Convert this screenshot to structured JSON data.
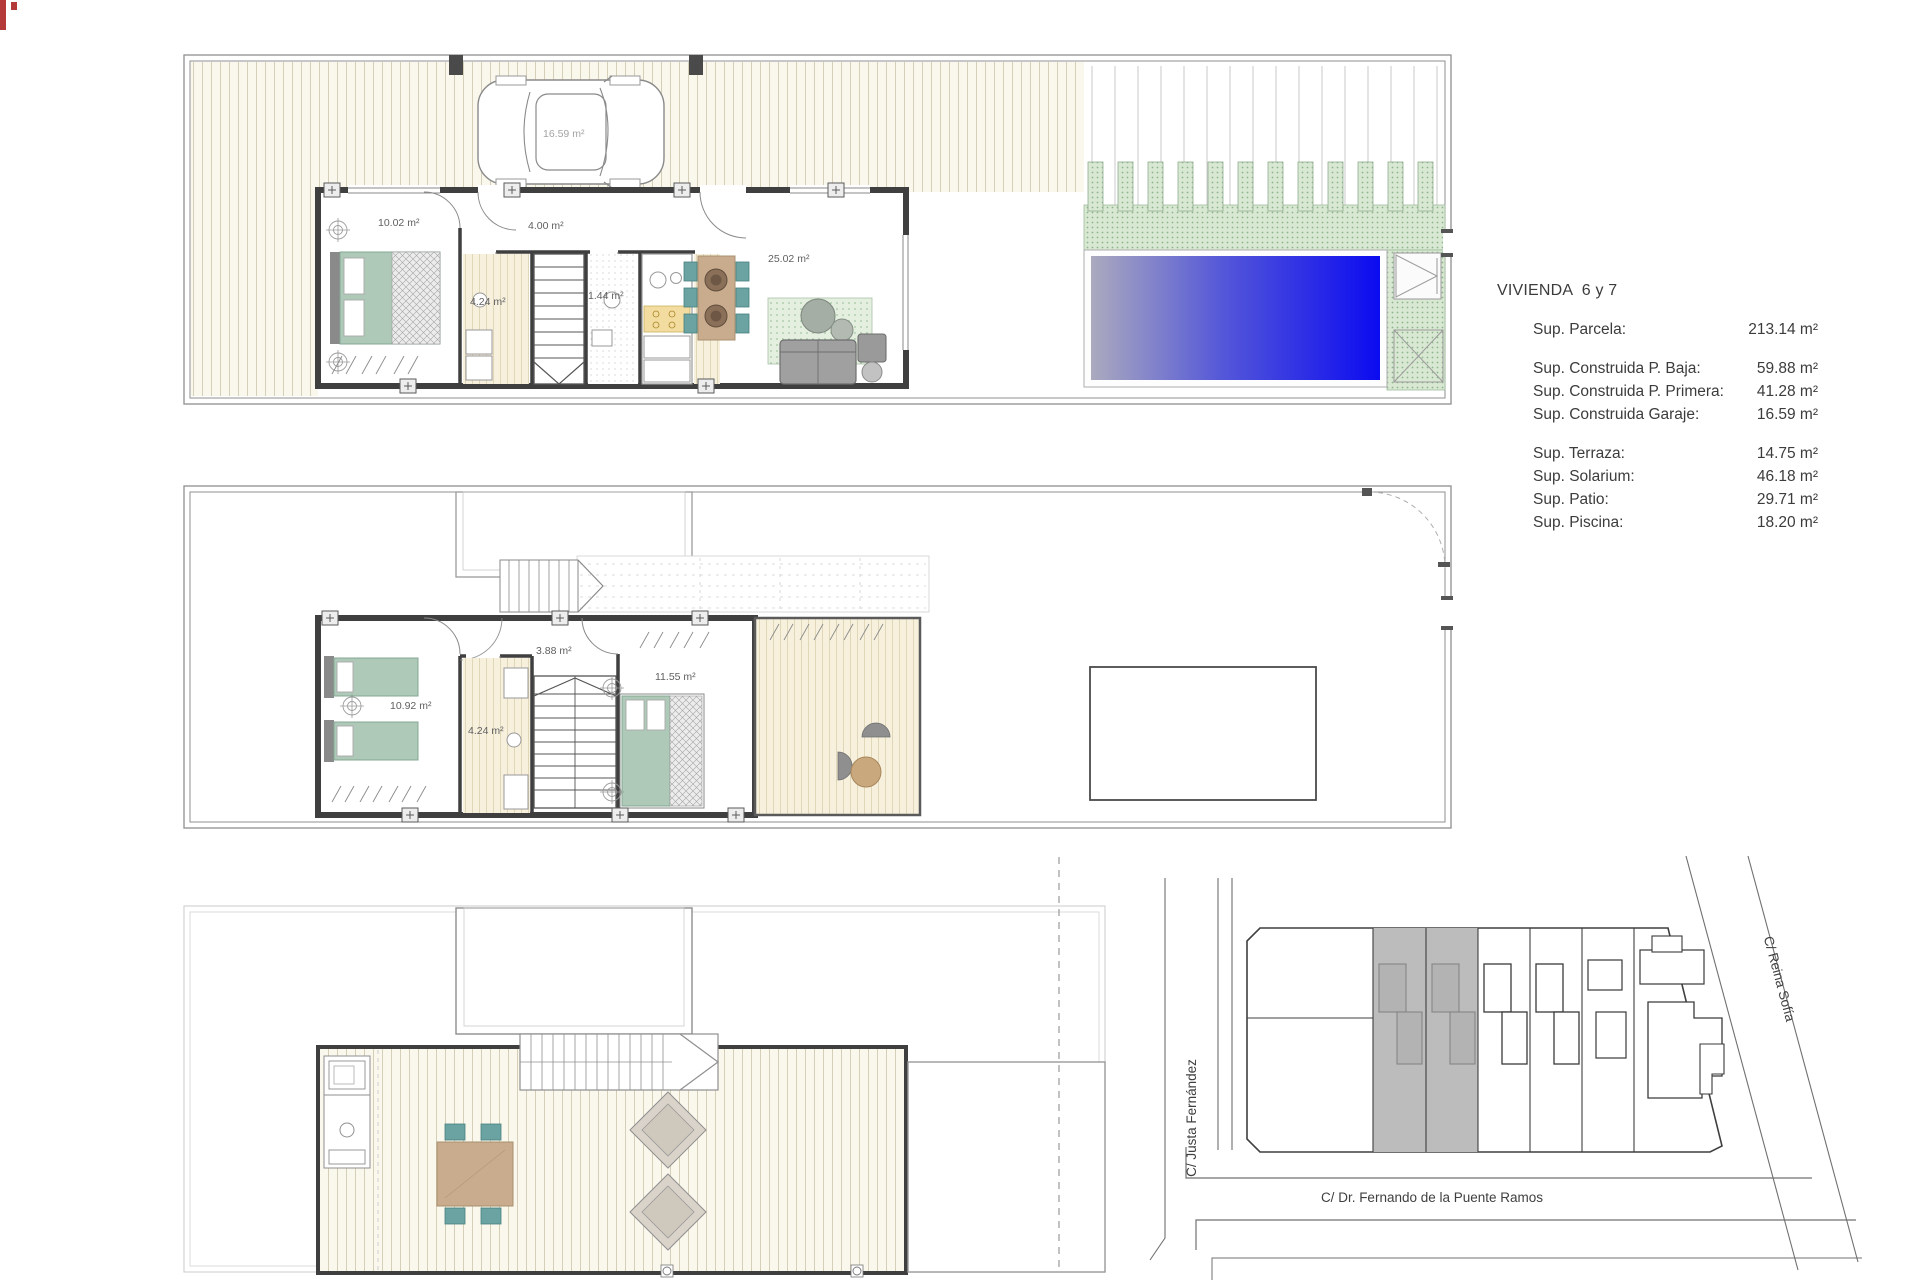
{
  "document": {
    "heading": "VIVIENDA  6 y 7",
    "summary": [
      {
        "label": "Sup. Parcela:",
        "value": "213.14 m²"
      },
      {
        "label": "Sup. Construida P. Baja:",
        "value": "59.88 m²"
      },
      {
        "label": "Sup. Construida P. Primera:",
        "value": "41.28 m²"
      },
      {
        "label": "Sup. Construida Garaje:",
        "value": "16.59 m²"
      },
      {
        "label": "Sup. Terraza:",
        "value": "14.75 m²"
      },
      {
        "label": "Sup. Solarium:",
        "value": "46.18 m²"
      },
      {
        "label": "Sup. Patio:",
        "value": "29.71 m²"
      },
      {
        "label": "Sup. Piscina:",
        "value": "18.20 m²"
      }
    ]
  },
  "ground_floor": {
    "garage_area": "16.59 m²",
    "bedroom_area": "10.02 m²",
    "hall_area": "4.00 m²",
    "bathroom_area": "4.24 m²",
    "wc_area": "1.44 m²",
    "living_area": "25.02 m²"
  },
  "first_floor": {
    "bedroom1_area": "10.92 m²",
    "bathroom_area": "4.24 m²",
    "hall_area": "3.88 m²",
    "bedroom2_area": "11.55 m²"
  },
  "site_plan": {
    "street_left": "C/ Justa Fernández",
    "street_bottom": "C/ Dr. Fernando de la Puente Ramos",
    "street_right": "C/ Reina Sofía"
  },
  "colors": {
    "pool_blue": "#0b0bf0",
    "pool_gray": "#abaabe",
    "terrace_green": "#d9e8d3",
    "terrace_dot_green": "#8cb48c",
    "furniture_green": "#aec9b8",
    "chair_teal": "#6ba3a3",
    "wood_tan": "#c9ab8e",
    "wall_gray": "#3f3f3f",
    "highlight_plot_gray": "#bcbcbc",
    "accent_red": "#b43a3a"
  }
}
